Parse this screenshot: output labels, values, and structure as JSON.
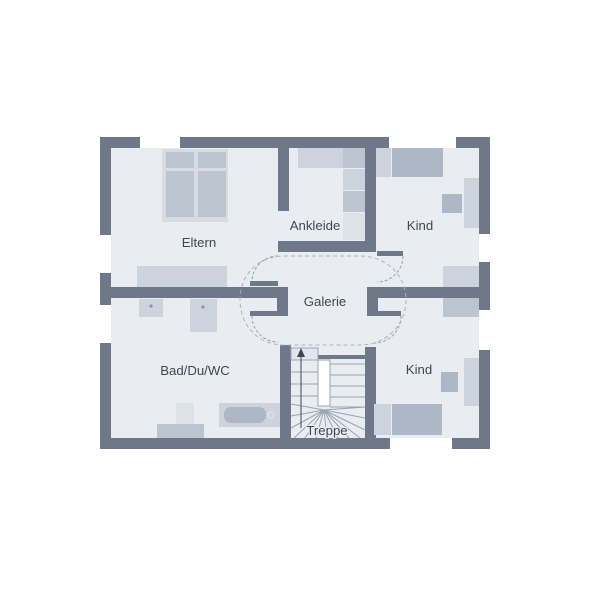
{
  "meta": {
    "width": 600,
    "height": 600,
    "type": "architectural-floor-plan",
    "floor": "upper-floor"
  },
  "labels": {
    "eltern": "Eltern",
    "ankleide": "Ankleide",
    "kind_top": "Kind",
    "galerie": "Galerie",
    "bad": "Bad/Du/WC",
    "kind_bottom": "Kind",
    "treppe": "Treppe"
  },
  "label_pos": [
    {
      "key": "eltern",
      "x": 199,
      "y": 247
    },
    {
      "key": "ankleide",
      "x": 315,
      "y": 230
    },
    {
      "key": "kind_top",
      "x": 420,
      "y": 230
    },
    {
      "key": "galerie",
      "x": 325,
      "y": 306
    },
    {
      "key": "bad",
      "x": 195,
      "y": 375
    },
    {
      "key": "kind_bottom",
      "x": 419,
      "y": 374
    },
    {
      "key": "treppe",
      "x": 327,
      "y": 435
    }
  ],
  "colors": {
    "wall": "#6e7888",
    "floor": "#e9ecf1",
    "light": "#cdd3dc",
    "mid": "#bcc4d0",
    "dark": "#aeb7c5",
    "frame": "#d7dce3",
    "lighter": "#dde2e9",
    "line": "#8d96a4",
    "stair": "#9aa3b1",
    "dash": "#aab2be",
    "text": "#3e4657",
    "white": "#ffffff",
    "landing": "#e2e6ec"
  },
  "plan": {
    "floor_rect": [
      100,
      137,
      390,
      312
    ],
    "walls": [
      [
        100,
        137,
        390,
        11
      ],
      [
        100,
        438,
        390,
        11
      ],
      [
        100,
        137,
        11,
        312
      ],
      [
        479,
        137,
        11,
        312
      ],
      [
        278,
        148,
        11,
        63
      ],
      [
        278,
        241,
        90,
        11
      ],
      [
        365,
        148,
        11,
        104
      ],
      [
        111,
        287,
        172,
        11
      ],
      [
        277,
        287,
        11,
        29
      ],
      [
        367,
        287,
        112,
        11
      ],
      [
        367,
        287,
        11,
        29
      ],
      [
        280,
        345,
        11,
        93
      ],
      [
        365,
        347,
        11,
        91
      ],
      [
        318,
        355,
        47,
        4
      ]
    ],
    "windows": [
      {
        "r": [
          140,
          137,
          40,
          11
        ],
        "o": "h"
      },
      {
        "r": [
          389,
          137,
          67,
          11
        ],
        "o": "h"
      },
      {
        "r": [
          100,
          235,
          11,
          38
        ],
        "o": "v"
      },
      {
        "r": [
          100,
          305,
          11,
          38
        ],
        "o": "v"
      },
      {
        "r": [
          479,
          234,
          11,
          28
        ],
        "o": "v"
      },
      {
        "r": [
          479,
          310,
          11,
          40
        ],
        "o": "v"
      },
      {
        "r": [
          390,
          438,
          62,
          11
        ],
        "o": "h"
      }
    ],
    "furniture": [
      {
        "name": "parents-bed-frame",
        "r": [
          162,
          149,
          66,
          73
        ],
        "fill": "frame"
      },
      {
        "name": "parents-bed-pillow-l",
        "r": [
          166,
          152,
          28,
          16
        ],
        "fill": "mid"
      },
      {
        "name": "parents-bed-pillow-r",
        "r": [
          198,
          152,
          28,
          16
        ],
        "fill": "mid"
      },
      {
        "name": "parents-bed-mattress-l",
        "r": [
          166,
          171,
          28,
          46
        ],
        "fill": "mid"
      },
      {
        "name": "parents-bed-mattress-r",
        "r": [
          198,
          171,
          28,
          46
        ],
        "fill": "mid"
      },
      {
        "name": "parents-dresser",
        "r": [
          137,
          266,
          90,
          21
        ],
        "fill": "light",
        "cells": 4
      },
      {
        "name": "wardrobe-top",
        "r": [
          298,
          148,
          45,
          20
        ],
        "fill": "light",
        "cells": 2
      },
      {
        "name": "wardrobe-cell-1",
        "r": [
          343,
          148,
          22,
          20
        ],
        "fill": "mid"
      },
      {
        "name": "wardrobe-cell-2",
        "r": [
          343,
          169,
          22,
          21
        ],
        "fill": "light"
      },
      {
        "name": "wardrobe-cell-3",
        "r": [
          343,
          191,
          22,
          21
        ],
        "fill": "mid"
      },
      {
        "name": "wardrobe-cell-4",
        "r": [
          343,
          213,
          22,
          27
        ],
        "fill": "lighter"
      },
      {
        "name": "child1-bed-pillow",
        "r": [
          376,
          148,
          15,
          29
        ],
        "fill": "light"
      },
      {
        "name": "child1-bed-mattress",
        "r": [
          392,
          148,
          51,
          29
        ],
        "fill": "dark"
      },
      {
        "name": "child1-desk",
        "r": [
          464,
          178,
          15,
          50
        ],
        "fill": "light"
      },
      {
        "name": "child1-dresser",
        "r": [
          443,
          266,
          36,
          21
        ],
        "fill": "light",
        "cells": 2
      },
      {
        "name": "child1-chair",
        "r": [
          442,
          194,
          20,
          19
        ],
        "fill": "dark",
        "rot": 25,
        "diag": true
      },
      {
        "name": "child2-dresser",
        "r": [
          443,
          298,
          36,
          19
        ],
        "fill": "mid",
        "cells": 2
      },
      {
        "name": "child2-desk",
        "r": [
          464,
          358,
          15,
          48
        ],
        "fill": "light"
      },
      {
        "name": "child2-chair",
        "r": [
          441,
          372,
          17,
          20
        ],
        "fill": "dark",
        "rot": 20,
        "diag": true
      },
      {
        "name": "child2-bed-pillow",
        "r": [
          374,
          404,
          17,
          31
        ],
        "fill": "light"
      },
      {
        "name": "child2-bed-mattress",
        "r": [
          392,
          404,
          50,
          31
        ],
        "fill": "dark"
      },
      {
        "name": "bath-basin",
        "r": [
          139,
          299,
          24,
          18
        ],
        "fill": "light"
      },
      {
        "name": "bath-shower",
        "r": [
          190,
          299,
          27,
          33
        ],
        "fill": "light"
      },
      {
        "name": "bath-wc",
        "r": [
          176,
          403,
          18,
          21
        ],
        "fill": "lighter"
      },
      {
        "name": "bath-wc-block",
        "r": [
          157,
          424,
          47,
          14
        ],
        "fill": "mid"
      },
      {
        "name": "bath-tub",
        "r": [
          219,
          403,
          61,
          24
        ],
        "fill": "light"
      },
      {
        "name": "bath-tub-inner",
        "r": [
          224,
          407,
          42,
          16
        ],
        "fill": "dark",
        "rx": 7
      }
    ],
    "dots": [
      {
        "name": "basin-faucet",
        "c": [
          151,
          306
        ],
        "r": 1.6
      },
      {
        "name": "shower-faucet",
        "c": [
          203,
          307
        ],
        "r": 1.6
      }
    ],
    "tub_drain": {
      "c": [
        271,
        415
      ],
      "r": 3
    },
    "doors": [
      {
        "name": "door-eltern",
        "leaf": [
          250,
          281,
          28,
          5
        ],
        "arc": "M 278 256 A 26 26 0 0 0 252 282"
      },
      {
        "name": "door-bad",
        "leaf": [
          250,
          311,
          28,
          5
        ],
        "arc": "M 252 316 A 26 26 0 0 0 278 342"
      },
      {
        "name": "door-kind-top",
        "leaf": [
          377,
          251,
          26,
          5
        ],
        "arc": "M 403 256 A 26 26 0 0 1 377 282"
      },
      {
        "name": "door-kind-bottom",
        "leaf": [
          374,
          311,
          27,
          5
        ],
        "arc": "M 401 316 A 27 27 0 0 1 374 343"
      }
    ],
    "cloud_path": "M 284 256 L 360 256 C 386 256 406 275 406 300 C 406 325 386 345 360 345 L 284 345 C 258 345 240 325 240 300 C 240 275 258 256 284 256 Z",
    "stairs": {
      "landing": [
        291,
        348,
        27,
        12
      ],
      "well": [
        318,
        360,
        12,
        46
      ],
      "left_treads": {
        "x1": 291,
        "x2": 318,
        "ys": [
          360,
          372,
          384,
          396
        ]
      },
      "right_treads": {
        "x1": 330,
        "x2": 365,
        "ys": [
          364,
          375,
          386,
          397,
          407
        ]
      },
      "fan_center": [
        324,
        410
      ],
      "fan_targets": [
        [
          291,
          404
        ],
        [
          291,
          416
        ],
        [
          291,
          428
        ],
        [
          294,
          438
        ],
        [
          305,
          438
        ],
        [
          316,
          438
        ],
        [
          327,
          438
        ],
        [
          338,
          438
        ],
        [
          349,
          438
        ],
        [
          360,
          438
        ],
        [
          365,
          430
        ],
        [
          365,
          418
        ],
        [
          365,
          407
        ]
      ],
      "walk_line": {
        "x": 301,
        "y1": 428,
        "y2": 354
      },
      "arrow": "301,348 297,357 305,357"
    }
  }
}
